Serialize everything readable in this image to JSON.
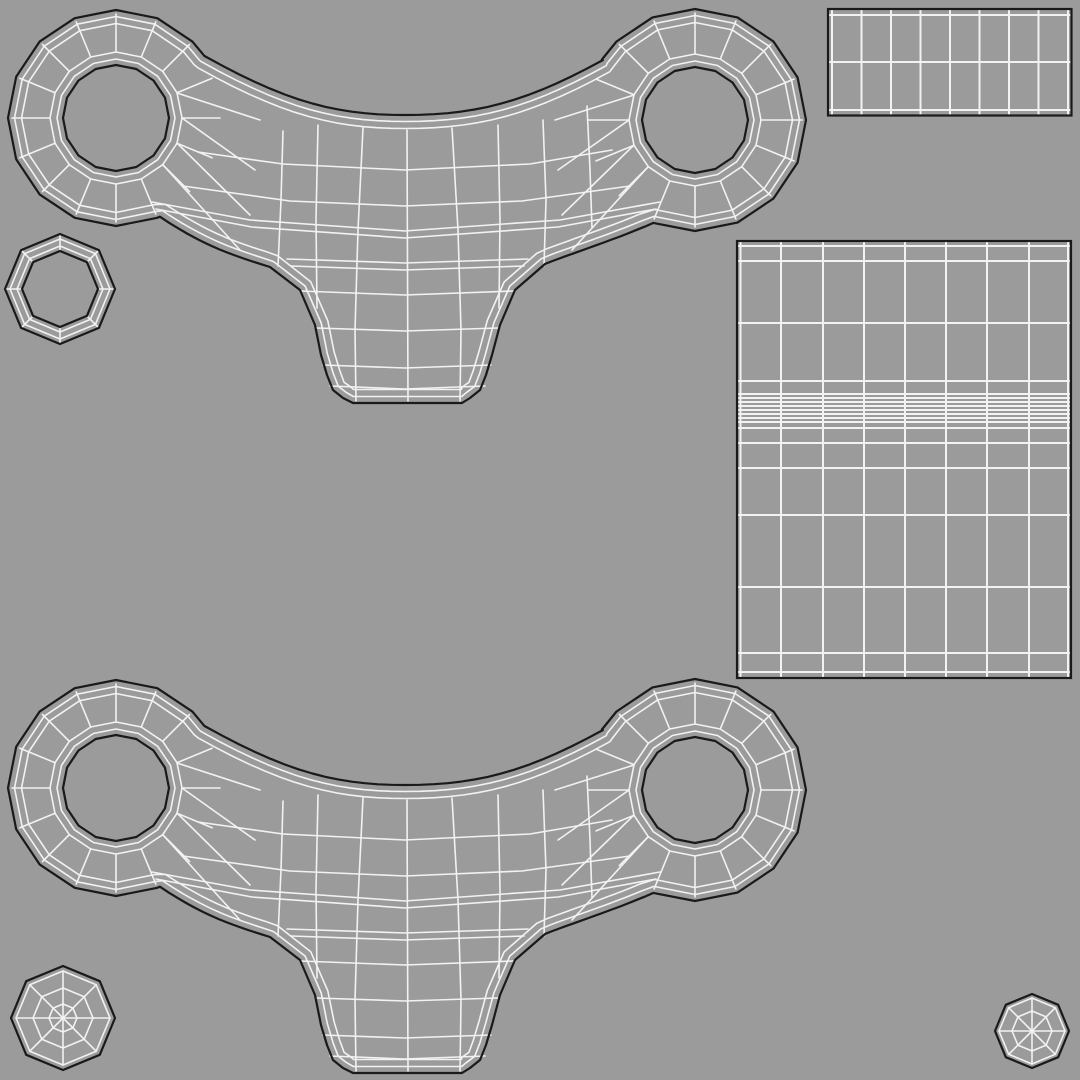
{
  "scene": {
    "width": 1080,
    "height": 1080,
    "background_color": "#9b9b9b",
    "wire_color": "#f2f2f2",
    "outline_color": "#1a1a1a",
    "wire_width": 1.6,
    "outline_width": 2.2,
    "grid_wire_width": 2.0
  },
  "clamp": {
    "instances": [
      {
        "name": "uv-island-clamp-top",
        "dy": 0
      },
      {
        "name": "uv-island-clamp-bottom",
        "dy": 670
      }
    ],
    "bosses": [
      {
        "name": "boss-left",
        "cx": 116,
        "cy": 118,
        "outer_r": 108,
        "hole_r": 53,
        "segments": 16,
        "rot": -90
      },
      {
        "name": "boss-right",
        "cx": 695,
        "cy": 120,
        "outer_r": 111,
        "hole_r": 53,
        "segments": 16,
        "rot": -90
      }
    ],
    "hole_ring_radii": [
      59,
      66
    ],
    "spoke_inner_r": 66,
    "spoke_outer_margin": 4,
    "silhouette_insets": [
      6.5,
      13.5
    ],
    "silhouette": [
      {
        "type": "cubic",
        "p": [
          [
            204.5,
            56
          ],
          [
            290,
            104
          ],
          [
            340,
            115
          ],
          [
            405,
            115
          ]
        ]
      },
      {
        "type": "cubic",
        "p": [
          [
            405,
            115
          ],
          [
            475,
            115
          ],
          [
            525,
            103
          ],
          [
            602.8,
            60.1
          ]
        ]
      },
      {
        "type": "arc",
        "boss": 1,
        "from": 213,
        "to": 472
      },
      {
        "type": "cubic",
        "p": [
          [
            653.4,
            222.9
          ],
          [
            612,
            241
          ],
          [
            575,
            252
          ],
          [
            545,
            264
          ]
        ]
      },
      {
        "type": "poly",
        "p": [
          [
            545,
            264
          ],
          [
            515,
            290
          ],
          [
            500,
            325
          ],
          [
            492,
            355
          ],
          [
            486,
            375
          ],
          [
            480,
            390
          ],
          [
            470,
            398
          ],
          [
            462,
            403
          ],
          [
            353,
            403
          ],
          [
            343,
            398
          ],
          [
            333,
            390
          ],
          [
            327,
            375
          ],
          [
            321,
            355
          ],
          [
            315,
            325
          ],
          [
            300,
            290
          ],
          [
            270,
            267
          ]
        ]
      },
      {
        "type": "cubic",
        "p": [
          [
            270,
            267
          ],
          [
            235,
            256
          ],
          [
            205,
            247
          ],
          [
            159.9,
            216.7
          ]
        ]
      },
      {
        "type": "arc",
        "boss": 0,
        "from": 66,
        "to": 325
      }
    ],
    "mesh_polylines": [
      [
        [
          283,
          131
        ],
        [
          281,
          200
        ],
        [
          278,
          266
        ]
      ],
      [
        [
          318,
          125
        ],
        [
          316,
          220
        ],
        [
          317,
          308
        ]
      ],
      [
        [
          363,
          128
        ],
        [
          358,
          230
        ],
        [
          355,
          330
        ],
        [
          356,
          401
        ]
      ],
      [
        [
          407,
          130
        ],
        [
          408,
          401
        ]
      ],
      [
        [
          452,
          128
        ],
        [
          458,
          230
        ],
        [
          461,
          330
        ],
        [
          460,
          401
        ]
      ],
      [
        [
          498,
          125
        ],
        [
          500,
          220
        ],
        [
          499,
          308
        ]
      ],
      [
        [
          543,
          120
        ],
        [
          546,
          200
        ],
        [
          544,
          266
        ]
      ],
      [
        [
          587,
          106
        ],
        [
          590,
          170
        ],
        [
          592,
          228
        ]
      ],
      [
        [
          198,
          152
        ],
        [
          283,
          164
        ],
        [
          405,
          170
        ],
        [
          530,
          164
        ],
        [
          612,
          150
        ]
      ],
      [
        [
          183,
          186
        ],
        [
          290,
          201
        ],
        [
          405,
          206
        ],
        [
          522,
          201
        ],
        [
          630,
          186
        ]
      ],
      [
        [
          152,
          202
        ],
        [
          250,
          220
        ],
        [
          405,
          231
        ],
        [
          560,
          220
        ],
        [
          660,
          202
        ]
      ],
      [
        [
          156,
          209
        ],
        [
          252,
          227
        ],
        [
          405,
          238
        ],
        [
          558,
          227
        ],
        [
          656,
          209
        ]
      ],
      [
        [
          287,
          259
        ],
        [
          405,
          263
        ],
        [
          528,
          259
        ]
      ],
      [
        [
          291,
          266
        ],
        [
          405,
          270
        ],
        [
          524,
          266
        ]
      ],
      [
        [
          300,
          291
        ],
        [
          405,
          295
        ],
        [
          514,
          291
        ]
      ],
      [
        [
          317,
          328
        ],
        [
          405,
          331
        ],
        [
          498,
          328
        ]
      ],
      [
        [
          323,
          365
        ],
        [
          405,
          368
        ],
        [
          491,
          365
        ]
      ],
      [
        [
          330,
          386
        ],
        [
          405,
          389
        ],
        [
          485,
          386
        ]
      ],
      [
        [
          177,
          93
        ],
        [
          260,
          120
        ]
      ],
      [
        [
          182,
          118
        ],
        [
          255,
          170
        ]
      ],
      [
        [
          177,
          143
        ],
        [
          250,
          215
        ]
      ],
      [
        [
          163,
          165
        ],
        [
          240,
          250
        ]
      ],
      [
        [
          634,
          95
        ],
        [
          555,
          120
        ]
      ],
      [
        [
          629,
          120
        ],
        [
          558,
          170
        ]
      ],
      [
        [
          634,
          145
        ],
        [
          562,
          215
        ]
      ],
      [
        [
          648,
          167
        ],
        [
          572,
          250
        ]
      ]
    ]
  },
  "octagons": [
    {
      "name": "uv-island-octagon-ring",
      "kind": "ring",
      "cx": 60,
      "cy": 289,
      "sides": 8,
      "rot": -90,
      "black_radii": [
        55,
        38
      ],
      "white_radii": [
        50,
        43
      ],
      "tick_from": 38,
      "tick_to": 55
    },
    {
      "name": "uv-island-octagon-web-left",
      "kind": "web",
      "cx": 63,
      "cy": 1018,
      "sides": 8,
      "rot": -90,
      "outer_r": 52,
      "white_radii": [
        47,
        30,
        14
      ],
      "spoke_r": 47
    },
    {
      "name": "uv-island-octagon-web-right",
      "kind": "web",
      "cx": 1032,
      "cy": 1031,
      "sides": 8,
      "rot": -90,
      "outer_r": 37,
      "white_radii": [
        33,
        20
      ],
      "spoke_r": 33
    }
  ],
  "grids": [
    {
      "name": "uv-island-grid-strip",
      "x": 828,
      "y": 9,
      "w": 243.5,
      "h": 106.5,
      "verticals": [
        832,
        861.5,
        891,
        920.5,
        950,
        979.5,
        1009,
        1038.5,
        1068
      ],
      "horizontals": [
        15,
        62,
        110
      ]
    },
    {
      "name": "uv-island-grid-panel",
      "x": 737,
      "y": 241,
      "w": 334,
      "h": 437,
      "verticals": [
        740.5,
        781,
        823,
        864,
        905,
        946,
        987,
        1029,
        1068
      ],
      "horizontals": [
        246,
        261,
        323,
        381,
        394,
        398,
        402,
        406,
        410,
        414,
        418,
        422,
        428,
        443,
        468,
        515,
        587,
        653,
        672
      ]
    }
  ]
}
